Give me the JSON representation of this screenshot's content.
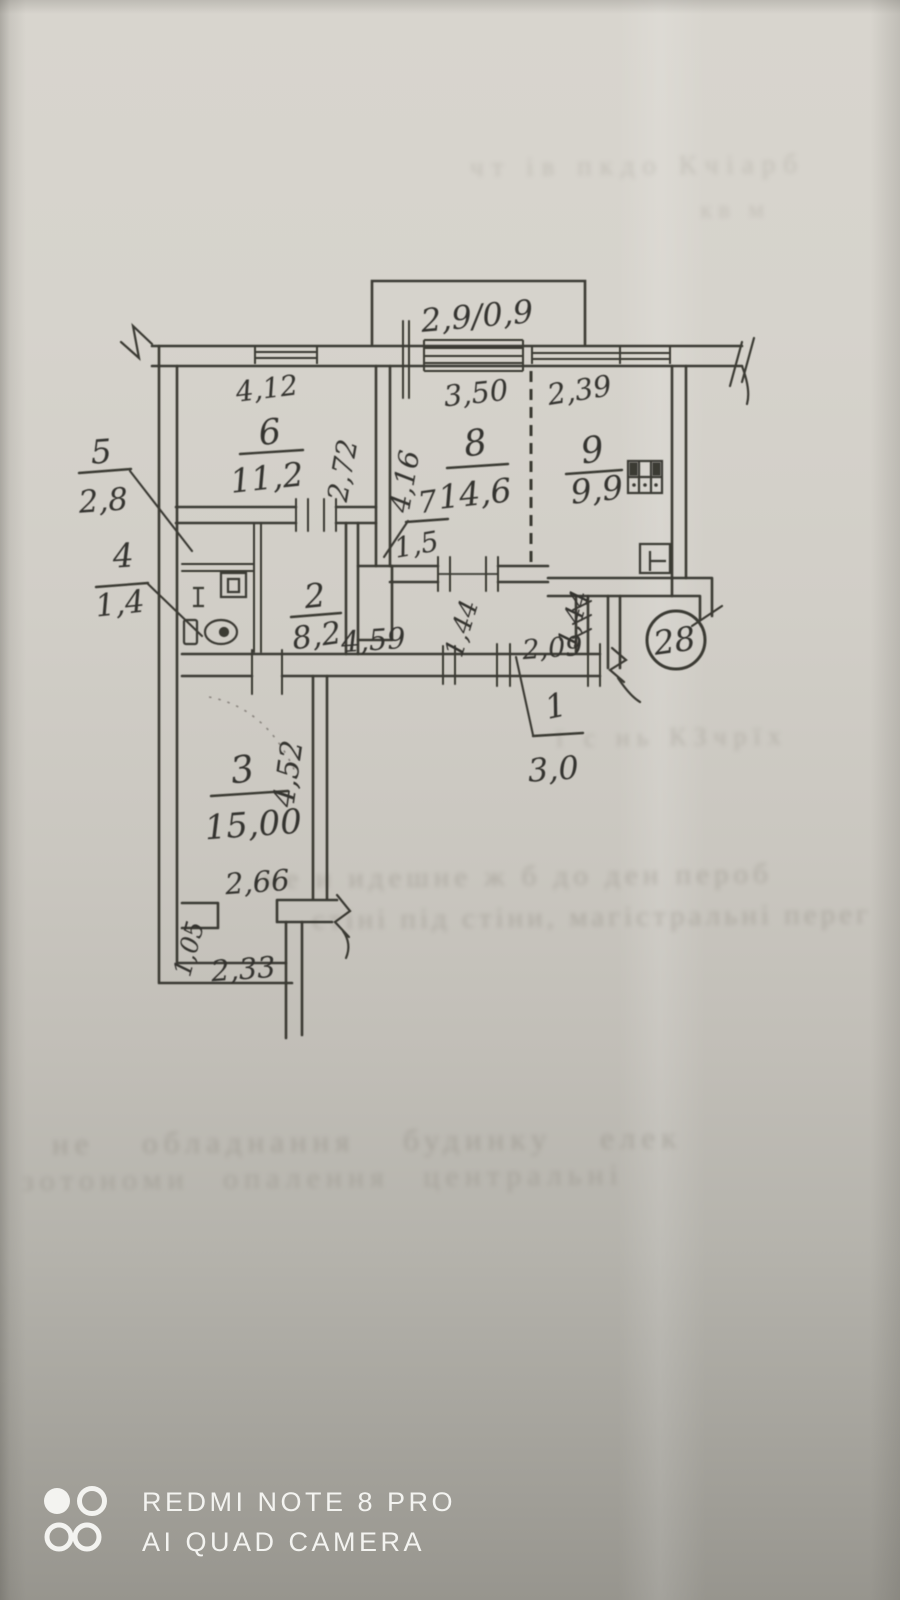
{
  "plan": {
    "apartment_badge": "28",
    "balcony": {
      "dim": "2,9/0,9"
    },
    "rooms": [
      {
        "no": "1",
        "area": "3,0"
      },
      {
        "no": "2",
        "area": "8,2"
      },
      {
        "no": "3",
        "area": "15,00"
      },
      {
        "no": "4",
        "area": "1,4"
      },
      {
        "no": "5",
        "area": "2,8"
      },
      {
        "no": "6",
        "area": "11,2"
      },
      {
        "no": "7",
        "area": "1,5"
      },
      {
        "no": "8",
        "area": "14,6"
      },
      {
        "no": "9",
        "area": "9,9"
      }
    ],
    "dimensions": {
      "d412": "4,12",
      "d350": "3,50",
      "d239": "2,39",
      "d272": "2,72",
      "d416": "4,16",
      "d459": "4,59",
      "d144a": "1,44",
      "d144b": "1,44",
      "d209": "2,09",
      "d452": "4,52",
      "d266": "2,66",
      "d105": "1,05",
      "d233": "2,33"
    }
  },
  "photo": {
    "watermark": {
      "line1": "REDMI NOTE 8 PRO",
      "line2": "AI QUAD CAMERA"
    },
    "bleedthrough": [
      {
        "text": "чт ів пкдо Кчіарб"
      },
      {
        "text": "кв м"
      },
      {
        "text": "ї с нь КЗчрїх"
      },
      {
        "text": "ме и идешне ж б до ден пероб"
      },
      {
        "text": "стіні під стіни, магістральні перег"
      },
      {
        "text": "не  обладнання  будинку  елек"
      },
      {
        "text": "зотономи опалення центральні"
      }
    ]
  }
}
